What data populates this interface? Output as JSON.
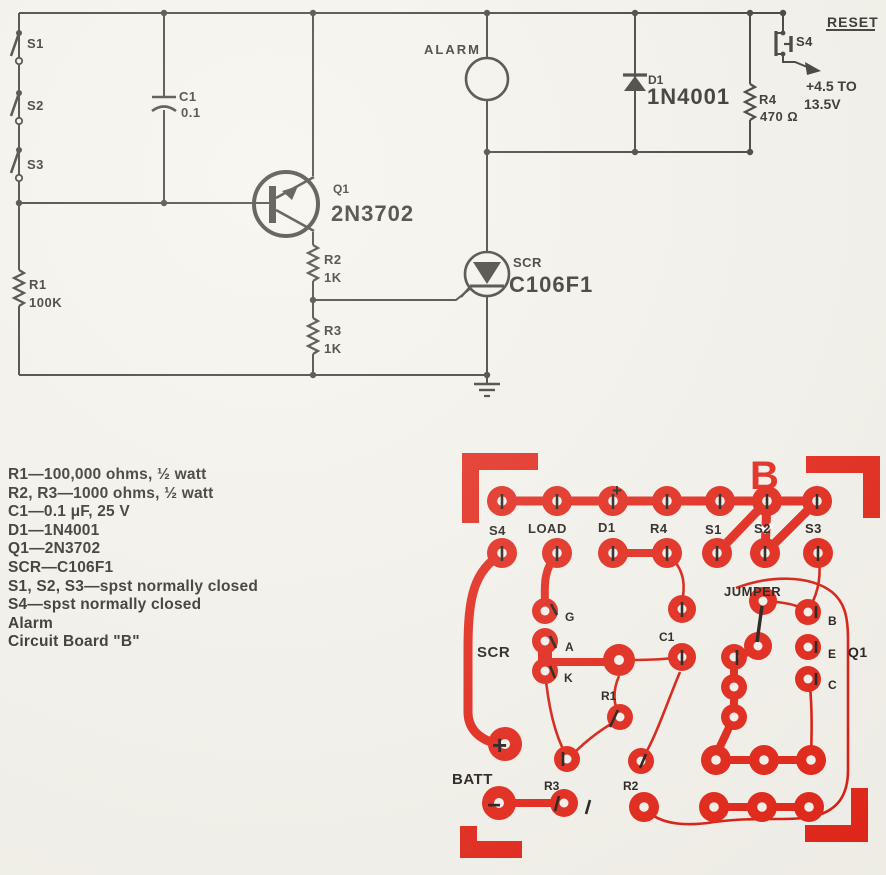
{
  "schematic": {
    "labels": {
      "s1": "S1",
      "s2": "S2",
      "s3": "S3",
      "c1_ref": "C1",
      "c1_val": "0.1",
      "q1_ref": "Q1",
      "q1_val": "2N3702",
      "alarm": "ALARM",
      "r1_ref": "R1",
      "r1_val": "100K",
      "r2_ref": "R2",
      "r2_val": "1K",
      "r3_ref": "R3",
      "r3_val": "1K",
      "scr_ref": "SCR",
      "scr_val": "C106F1",
      "d1_ref": "D1",
      "d1_val": "1N4001",
      "r4_ref": "R4",
      "r4_val": "470 Ω",
      "reset": "RESET",
      "s4": "S4",
      "supply_line1": "+4.5 TO",
      "supply_line2": "13.5V"
    }
  },
  "parts_list": {
    "lines": [
      "R1—100,000 ohms, ½ watt",
      "R2, R3—1000 ohms, ½ watt",
      "C1—0.1 μF, 25 V",
      "D1—1N4001",
      "Q1—2N3702",
      "SCR—C106F1",
      "S1, S2, S3—spst normally closed",
      "S4—spst normally closed",
      "Alarm",
      "Circuit Board \"B\""
    ]
  },
  "pcb": {
    "title": "B",
    "labels": {
      "s4": "S4",
      "load": "LOAD",
      "d1": "D1",
      "r4": "R4",
      "s1": "S1",
      "s2": "S2",
      "s3": "S3",
      "d1_plus": "+",
      "scr": "SCR",
      "g": "G",
      "a": "A",
      "k": "K",
      "r1": "R1",
      "c1": "C1",
      "jumper": "JUMPER",
      "q1": "Q1",
      "b": "B",
      "e": "E",
      "c": "C",
      "batt": "BATT",
      "batt_plus": "+",
      "batt_minus": "−",
      "r3": "R3",
      "r2": "R2"
    }
  },
  "colors": {
    "background": "#f5f3ec",
    "ink": "#3b382f",
    "copper": "#e42517",
    "copper_trace": "#d91d10",
    "silk": "#221d19"
  }
}
